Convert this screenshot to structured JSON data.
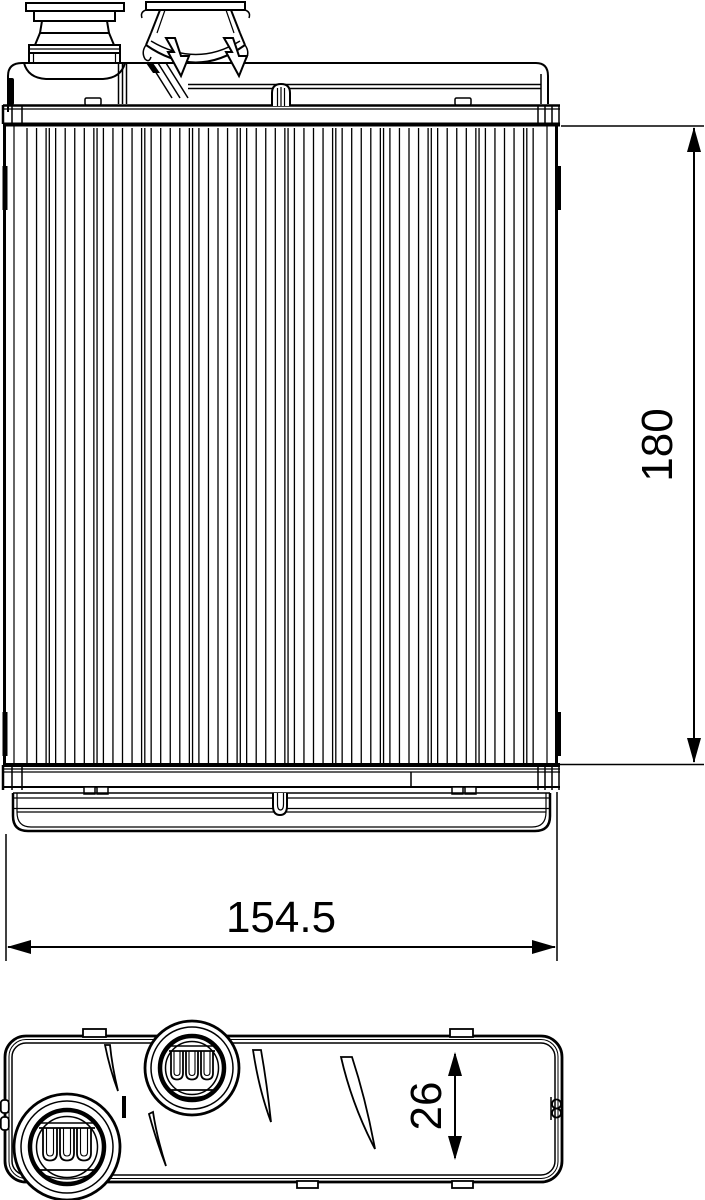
{
  "meta": {
    "background_color": "#ffffff",
    "line_color": "#000000"
  },
  "front_view": {
    "height_dimension": "180",
    "width_dimension": "154.5"
  },
  "top_view": {
    "depth_dimension": "26"
  }
}
